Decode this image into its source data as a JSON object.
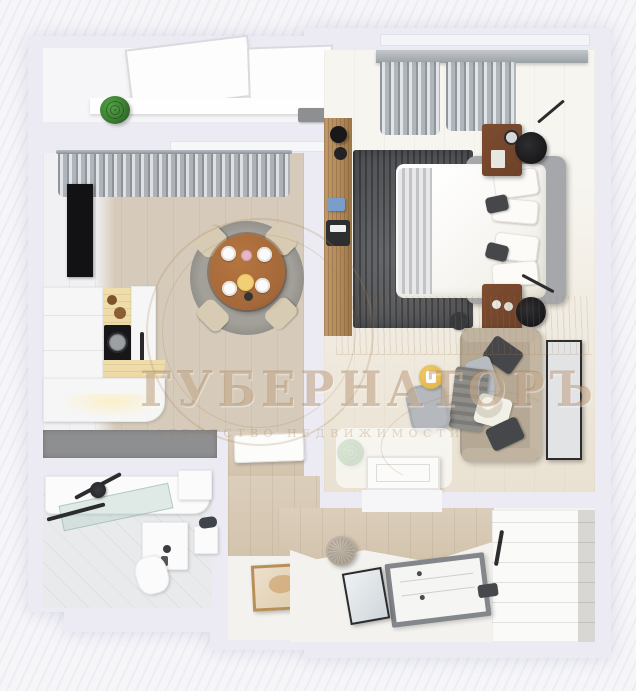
{
  "watermark": {
    "brand": "ГУБЕРНАТОРЪ",
    "tagline": "АГЕНТСТВО НЕДВИЖИМОСТИ"
  },
  "colors": {
    "bg": "#f6f6f9",
    "wall": "#ecebf3",
    "kitchen-floor": "#d6cbba",
    "kitchen-floor-dark": "#c9bca8",
    "bedroom-floor": "#f1ece2",
    "bedroom-floor-light": "#f7f5f0",
    "balcony-floor": "#f6f6f8",
    "bath-floor": "#e8eaec",
    "hall-floor": "#f3f2ee",
    "wood-band": "#dbcebb",
    "shaft": "#8e8f91",
    "rug-dark": "#55575a",
    "rug-dining": "#a3a09a",
    "table-wood": "#a4683a",
    "chair-beige": "#d8cbb4",
    "nightstand": "#6d422a",
    "console": "#b1895b",
    "curtain": "#b6bac0",
    "cornice": "#9aa0a5",
    "bed-frame": "#a6a7aa",
    "bed-white": "#f8f7f4",
    "pillow-dark": "#46474a",
    "sofa": "#b5a995",
    "armchair": "#b5b8bd",
    "lamp-yellow": "#e3b84e",
    "plant": "#3c7d33",
    "plant-dark": "#2a5c24",
    "counter-white": "#f6f6f6",
    "counter-wood": "#e9d7a2",
    "cooktop": "#17171a",
    "tv": "#121214",
    "glass": "#bcd4cb",
    "frame-dark": "#2b2c2e",
    "art-bg": "#e2e3e5",
    "door-frame": "#83868b",
    "wardrobe": "#fafaf9",
    "wardrobe-shade": "#d9d7d3",
    "watermark-strong": "rgba(168,126,84,0.42)",
    "watermark-soft": "rgba(168,126,84,0.30)",
    "watermark-line": "rgba(168,126,84,0.22)"
  }
}
